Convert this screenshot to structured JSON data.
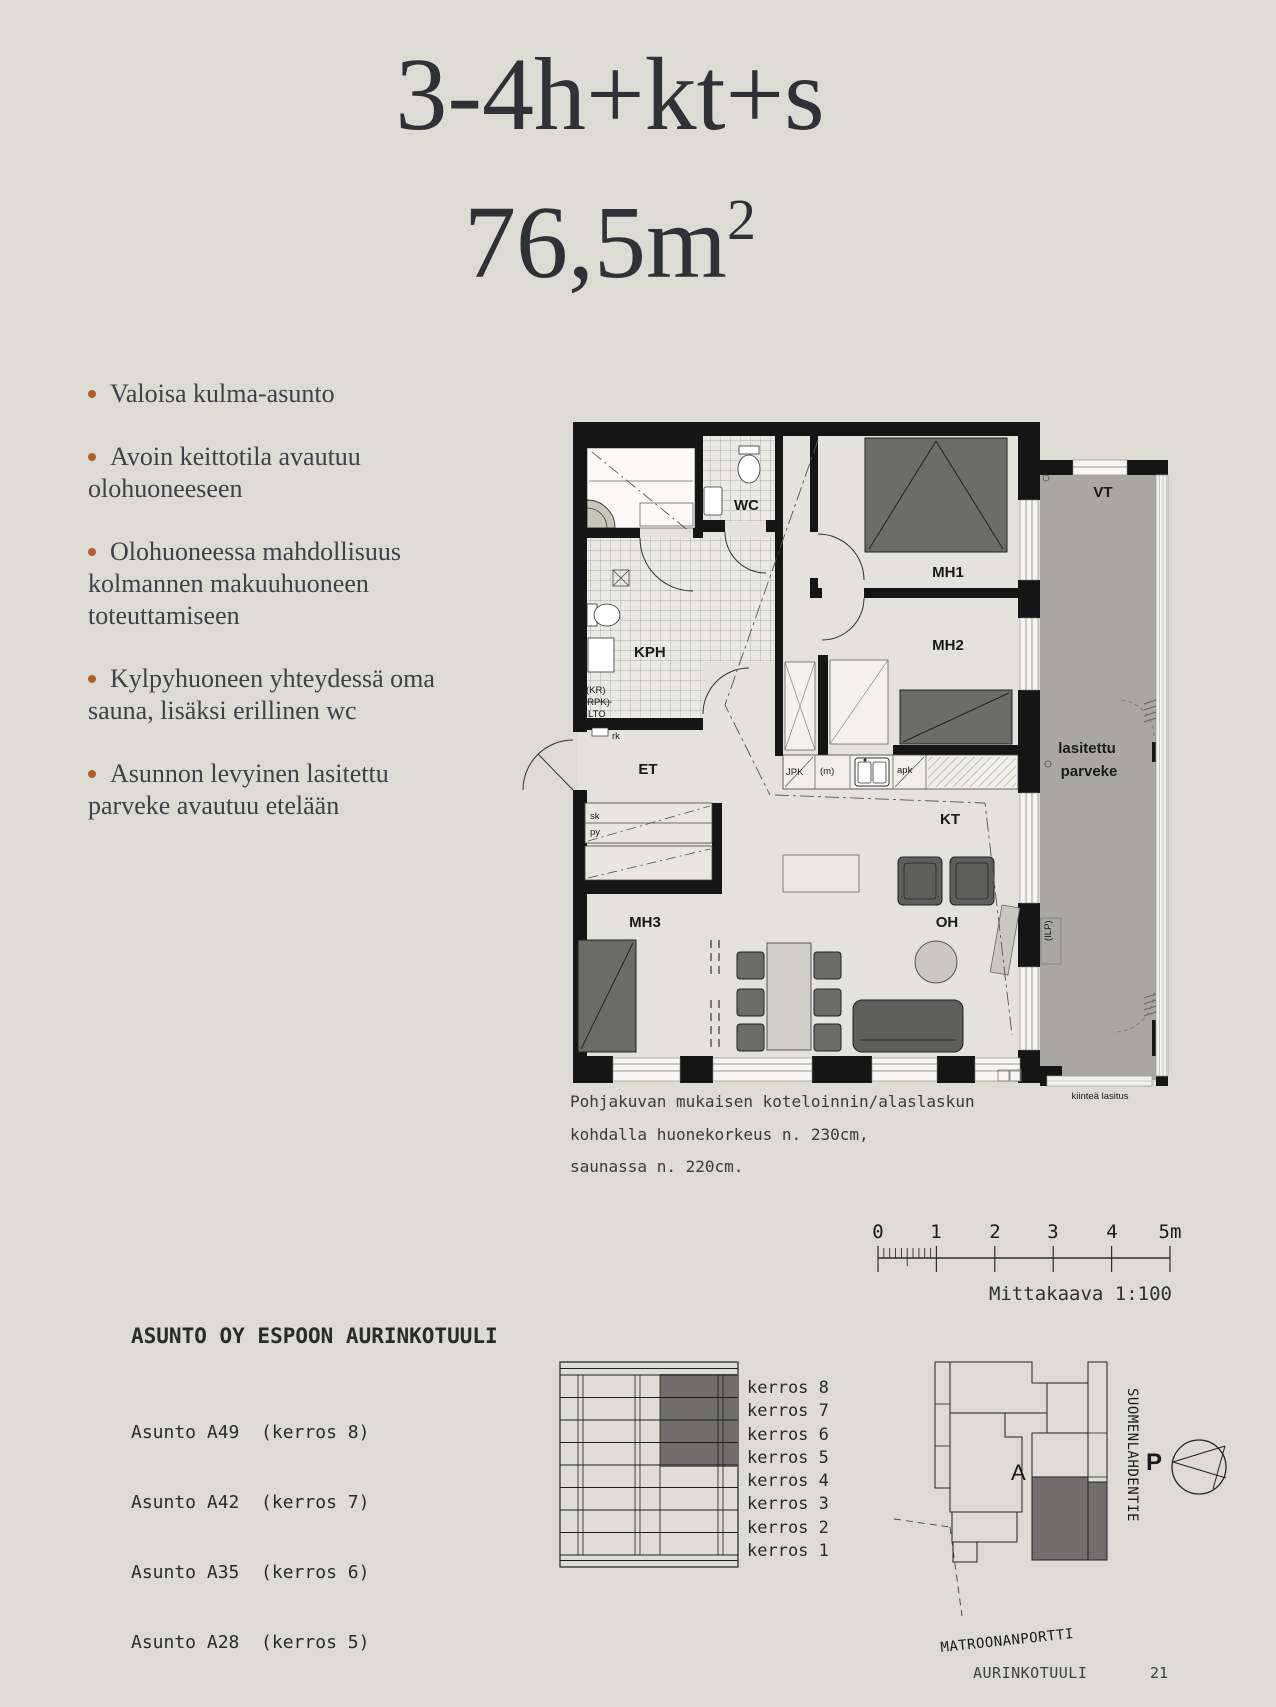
{
  "header": {
    "type_label": "3-4h+kt+s",
    "area_value": "76,5m",
    "area_sup": "2"
  },
  "features": [
    "Valoisa kulma-asunto",
    "Avoin keittotila avautuu olohuoneeseen",
    "Olohuoneessa mahdollisuus kolmannen makuuhuoneen toteuttamiseen",
    "Kylpyhuoneen yhteydessä oma sauna, lisäksi erillinen wc",
    "Asunnon levyinen lasitettu parveke avautuu etelään"
  ],
  "floorplan": {
    "rooms": {
      "vt": "VT",
      "wc": "WC",
      "kph": "KPH",
      "mh1": "MH1",
      "mh2": "MH2",
      "mh3": "MH3",
      "et": "ET",
      "kt": "KT",
      "oh": "OH",
      "balcony_line1": "lasitettu",
      "balcony_line2": "parveke"
    },
    "small_labels": {
      "kr": "(KR)",
      "rpk": "(RPK)",
      "lto": "LTO",
      "rk": "rk",
      "sk": "sk",
      "py": "py",
      "jpk": "JPK",
      "m": "(m)",
      "apk": "apk",
      "ilp": "(ILP)",
      "fixed_glazing": "kiinteä lasitus"
    },
    "caption_lines": [
      "Pohjakuvan mukaisen koteloinnin/alaslaskun",
      "kohdalla huonekorkeus n. 230cm,",
      "saunassa n. 220cm."
    ]
  },
  "scalebar": {
    "ticks": [
      "0",
      "1",
      "2",
      "3",
      "4",
      "5m"
    ],
    "label": "Mittakaava 1:100"
  },
  "project": {
    "heading": "ASUNTO OY ESPOON AURINKOTUULI",
    "apartments": [
      "Asunto A49  (kerros 8)",
      "Asunto A42  (kerros 7)",
      "Asunto A35  (kerros 6)",
      "Asunto A28  (kerros 5)"
    ]
  },
  "elevation": {
    "floors": [
      "kerros 8",
      "kerros 7",
      "kerros 6",
      "kerros 5",
      "kerros 4",
      "kerros 3",
      "kerros 2",
      "kerros 1"
    ]
  },
  "sitemap": {
    "building_label": "A",
    "street_side": "SUOMENLAHDENTIE",
    "street_bottom": "MATROONANPORTTI",
    "north": "P"
  },
  "footer": {
    "project": "AURINKOTUULI",
    "page": "21"
  },
  "colors": {
    "background": "#dcdbd4",
    "wall": "#151515",
    "balcony": "#a8a7a2",
    "highlight_dark": "#6f6e6c",
    "accent_bullet": "#b35c28"
  }
}
